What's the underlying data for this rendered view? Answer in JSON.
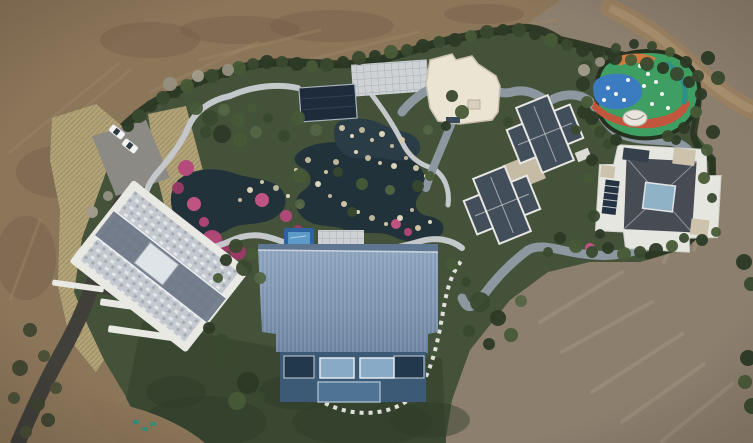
{
  "scene": {
    "description": "Aerial drone photograph of a landscaped private estate: a large blue-ribbed-roof barn house, a slate-roofed villa complex, a white flat-roof pavilion building, an ornamental garden with winding ponds, pink flower beds and stone paths, a colorful painted playground, a parking area with two white cars, curving roads, all surrounded by bare brown earth"
  },
  "palette": {
    "dirt_base": "#8c765a",
    "dirt_right": "#8d7f6e",
    "dirt_dark": "#76604a",
    "dirt_road": "#9a8162",
    "dirt_road_center": "#ab9270",
    "grass": "#44523a",
    "lawn": "#3a4832",
    "hedge": "#263220",
    "dry_grass": "#b2a378",
    "pond": "#22323b",
    "pond_light": "#2a3c46",
    "path_stone": "#c4c8cb",
    "road_loop": "#8d97a0",
    "asphalt": "#413f3a",
    "parking": "#8c8a85",
    "pavilion_roof": "#1d2b3b",
    "white_building": "#ece4d3",
    "white_building_edge": "#c9c0ae",
    "slate_roof": "#434e5b",
    "flat_white_roof": "#dcdcd6",
    "tan_courtyard": "#c6bca6",
    "right_house_white": "#e6e6e1",
    "right_house_dark": "#464b54",
    "skylight": "#8fb2c6",
    "slat_window": "#243241",
    "beige_patch": "#cdc2ab",
    "barn_roof_hi": "#8aa1bc",
    "barn_roof_lo": "#69809e",
    "facade": "#3c5a76",
    "window_glass": "#88aac6",
    "window_dark": "#22384c",
    "pool_border": "#2e63a2",
    "pool_inner": "#5c9bc8",
    "patio": "#ced2d5",
    "stepping_stone": "#e9e9e3",
    "playground_green": "#3f9e62",
    "playground_blue": "#3b7cc0",
    "playground_red": "#c2563c",
    "playground_orange": "#cf7a3e",
    "playground_teal": "#2e8f88",
    "dome_white": "#e8e6df",
    "car_white": "#f3f4f3",
    "car_glass": "#2f3a42",
    "terrace_white": "#e9e9e4",
    "flower_pink": "#b5477a"
  },
  "scatter": {
    "trees": {
      "colors": [
        "#2c3a26",
        "#39492e",
        "#475a36",
        "#536545"
      ],
      "items": [
        [
          128,
          126,
          6,
          0
        ],
        [
          139,
          116,
          7,
          1
        ],
        [
          151,
          106,
          6,
          0
        ],
        [
          163,
          98,
          7,
          1
        ],
        [
          175,
          92,
          6,
          0
        ],
        [
          187,
          86,
          7,
          2
        ],
        [
          199,
          80,
          6,
          0
        ],
        [
          212,
          76,
          7,
          1
        ],
        [
          225,
          72,
          6,
          0
        ],
        [
          239,
          68,
          7,
          2
        ],
        [
          253,
          64,
          6,
          1
        ],
        [
          267,
          62,
          7,
          0
        ],
        [
          282,
          62,
          6,
          1
        ],
        [
          297,
          64,
          7,
          0
        ],
        [
          312,
          66,
          6,
          2
        ],
        [
          327,
          65,
          7,
          1
        ],
        [
          343,
          62,
          6,
          0
        ],
        [
          359,
          58,
          7,
          1
        ],
        [
          375,
          56,
          6,
          0
        ],
        [
          391,
          52,
          7,
          2
        ],
        [
          407,
          50,
          6,
          1
        ],
        [
          423,
          46,
          7,
          0
        ],
        [
          439,
          42,
          6,
          1
        ],
        [
          455,
          40,
          7,
          0
        ],
        [
          471,
          36,
          6,
          2
        ],
        [
          487,
          32,
          7,
          1
        ],
        [
          503,
          30,
          6,
          0
        ],
        [
          519,
          30,
          7,
          1
        ],
        [
          535,
          34,
          6,
          0
        ],
        [
          551,
          40,
          7,
          2
        ],
        [
          567,
          45,
          6,
          1
        ],
        [
          583,
          50,
          7,
          0
        ],
        [
          599,
          54,
          6,
          1
        ],
        [
          615,
          58,
          7,
          0
        ],
        [
          631,
          60,
          6,
          2
        ],
        [
          647,
          64,
          7,
          1
        ],
        [
          663,
          68,
          6,
          0
        ],
        [
          677,
          74,
          7,
          1
        ],
        [
          689,
          82,
          6,
          0
        ],
        [
          196,
          108,
          7,
          2
        ],
        [
          210,
          118,
          8,
          1
        ],
        [
          224,
          110,
          6,
          3
        ],
        [
          238,
          120,
          7,
          2
        ],
        [
          206,
          132,
          6,
          1
        ],
        [
          222,
          134,
          9,
          0
        ],
        [
          240,
          140,
          7,
          2
        ],
        [
          256,
          132,
          6,
          3
        ],
        [
          268,
          118,
          5,
          1
        ],
        [
          252,
          108,
          5,
          2
        ],
        [
          298,
          118,
          7,
          2
        ],
        [
          284,
          136,
          6,
          1
        ],
        [
          316,
          130,
          6,
          3
        ],
        [
          300,
          176,
          7,
          2
        ],
        [
          338,
          172,
          5,
          1
        ],
        [
          362,
          184,
          6,
          2
        ],
        [
          390,
          190,
          5,
          3
        ],
        [
          418,
          186,
          6,
          1
        ],
        [
          430,
          176,
          5,
          2
        ],
        [
          352,
          212,
          5,
          1
        ],
        [
          300,
          204,
          5,
          3
        ],
        [
          452,
          96,
          6,
          1
        ],
        [
          462,
          112,
          7,
          2
        ],
        [
          446,
          126,
          5,
          0
        ],
        [
          428,
          130,
          5,
          3
        ],
        [
          508,
          122,
          5,
          1
        ],
        [
          584,
          112,
          7,
          0
        ],
        [
          596,
          126,
          6,
          2
        ],
        [
          576,
          130,
          5,
          1
        ],
        [
          236,
          246,
          7,
          1
        ],
        [
          252,
          254,
          6,
          2
        ],
        [
          226,
          260,
          6,
          0
        ],
        [
          244,
          268,
          8,
          1
        ],
        [
          260,
          278,
          6,
          3
        ],
        [
          218,
          278,
          5,
          2
        ],
        [
          230,
          360,
          12,
          1
        ],
        [
          248,
          383,
          11,
          0
        ],
        [
          237,
          401,
          9,
          2
        ],
        [
          222,
          342,
          8,
          1
        ],
        [
          209,
          328,
          6,
          0
        ],
        [
          258,
          398,
          7,
          1
        ],
        [
          480,
          302,
          10,
          1
        ],
        [
          498,
          318,
          8,
          0
        ],
        [
          511,
          335,
          7,
          2
        ],
        [
          469,
          331,
          6,
          1
        ],
        [
          521,
          301,
          6,
          3
        ],
        [
          452,
          264,
          6,
          2
        ],
        [
          466,
          282,
          5,
          1
        ],
        [
          489,
          344,
          6,
          0
        ],
        [
          548,
          252,
          5,
          1
        ],
        [
          560,
          238,
          6,
          0
        ],
        [
          576,
          246,
          7,
          2
        ],
        [
          592,
          252,
          6,
          1
        ],
        [
          608,
          248,
          6,
          0
        ],
        [
          624,
          254,
          7,
          2
        ],
        [
          640,
          252,
          6,
          1
        ],
        [
          656,
          250,
          7,
          0
        ],
        [
          672,
          246,
          6,
          2
        ],
        [
          684,
          238,
          5,
          1
        ],
        [
          592,
          160,
          6,
          0
        ],
        [
          588,
          178,
          5,
          2
        ],
        [
          594,
          216,
          6,
          1
        ],
        [
          600,
          234,
          5,
          0
        ],
        [
          704,
          178,
          6,
          2
        ],
        [
          712,
          198,
          5,
          1
        ],
        [
          702,
          240,
          6,
          0
        ],
        [
          716,
          232,
          5,
          2
        ],
        [
          608,
          144,
          5,
          1
        ],
        [
          676,
          140,
          5,
          0
        ],
        [
          598,
          52,
          6,
          0
        ],
        [
          586,
          66,
          6,
          1
        ],
        [
          583,
          84,
          7,
          0
        ],
        [
          587,
          102,
          6,
          2
        ],
        [
          592,
          118,
          7,
          0
        ],
        [
          600,
          132,
          6,
          1
        ],
        [
          616,
          140,
          6,
          0
        ],
        [
          668,
          136,
          6,
          1
        ],
        [
          684,
          128,
          6,
          0
        ],
        [
          696,
          112,
          6,
          2
        ],
        [
          701,
          94,
          6,
          0
        ],
        [
          698,
          76,
          6,
          1
        ],
        [
          686,
          62,
          6,
          0
        ],
        [
          670,
          52,
          5,
          2
        ],
        [
          652,
          46,
          5,
          1
        ],
        [
          634,
          44,
          5,
          0
        ],
        [
          616,
          48,
          5,
          1
        ],
        [
          708,
          58,
          7,
          0
        ],
        [
          718,
          78,
          7,
          1
        ],
        [
          713,
          132,
          7,
          0
        ],
        [
          707,
          150,
          6,
          2
        ],
        [
          744,
          262,
          8,
          0
        ],
        [
          751,
          284,
          7,
          1
        ],
        [
          748,
          358,
          8,
          0
        ],
        [
          745,
          382,
          7,
          2
        ],
        [
          752,
          406,
          8,
          1
        ]
      ]
    },
    "scrub": {
      "colors": [
        "#3f4430",
        "#4a4f36"
      ],
      "items": [
        [
          30,
          330,
          7
        ],
        [
          44,
          356,
          6
        ],
        [
          20,
          368,
          8
        ],
        [
          56,
          388,
          6
        ],
        [
          38,
          404,
          7
        ],
        [
          14,
          398,
          6
        ],
        [
          48,
          420,
          7
        ],
        [
          26,
          432,
          6
        ]
      ]
    },
    "bare": {
      "colors": [
        "#96907f",
        "#a39d8c"
      ],
      "items": [
        [
          170,
          84,
          7
        ],
        [
          198,
          76,
          6
        ],
        [
          228,
          70,
          6
        ],
        [
          584,
          70,
          6
        ],
        [
          600,
          62,
          5
        ],
        [
          92,
          212,
          6
        ],
        [
          108,
          196,
          5
        ]
      ]
    },
    "rocks": {
      "colors": [
        "#d8cbaa",
        "#e7ddc2",
        "#c7bda2"
      ],
      "items": [
        [
          342,
          128,
          3
        ],
        [
          352,
          136,
          2
        ],
        [
          362,
          130,
          3
        ],
        [
          372,
          140,
          2
        ],
        [
          382,
          134,
          3
        ],
        [
          392,
          146,
          2
        ],
        [
          402,
          140,
          3
        ],
        [
          356,
          152,
          2
        ],
        [
          368,
          158,
          3
        ],
        [
          380,
          163,
          2
        ],
        [
          394,
          166,
          3
        ],
        [
          406,
          158,
          2
        ],
        [
          416,
          168,
          3
        ],
        [
          426,
          176,
          2
        ],
        [
          336,
          162,
          3
        ],
        [
          326,
          172,
          2
        ],
        [
          318,
          184,
          3
        ],
        [
          330,
          196,
          2
        ],
        [
          344,
          204,
          3
        ],
        [
          358,
          212,
          2
        ],
        [
          372,
          218,
          3
        ],
        [
          386,
          224,
          2
        ],
        [
          400,
          218,
          3
        ],
        [
          412,
          210,
          2
        ],
        [
          300,
          206,
          3
        ],
        [
          288,
          196,
          2
        ],
        [
          276,
          188,
          3
        ],
        [
          262,
          182,
          2
        ],
        [
          250,
          190,
          3
        ],
        [
          240,
          200,
          2
        ],
        [
          418,
          228,
          3
        ],
        [
          430,
          222,
          2
        ],
        [
          308,
          160,
          3
        ],
        [
          296,
          170,
          2
        ]
      ]
    },
    "flowers": {
      "colors": [
        "#b5477a",
        "#9c3a66",
        "#c85585"
      ],
      "items": [
        [
          186,
          168,
          8
        ],
        [
          178,
          188,
          6
        ],
        [
          194,
          204,
          7
        ],
        [
          212,
          240,
          10
        ],
        [
          238,
          252,
          8
        ],
        [
          262,
          200,
          7
        ],
        [
          286,
          216,
          6
        ],
        [
          298,
          230,
          5
        ],
        [
          396,
          224,
          5
        ],
        [
          408,
          232,
          4
        ],
        [
          352,
          240,
          4
        ],
        [
          590,
          248,
          5
        ],
        [
          204,
          222,
          5
        ],
        [
          226,
          246,
          6
        ]
      ]
    }
  },
  "lines": {
    "dirt_streaks": {
      "stroke": "#9d8767",
      "w": 3,
      "op": 0.45,
      "items": [
        [
          10,
          152,
          118,
          64
        ],
        [
          150,
          92,
          258,
          42
        ],
        [
          300,
          62,
          418,
          32
        ],
        [
          430,
          42,
          556,
          20
        ],
        [
          40,
          220,
          10,
          300
        ],
        [
          70,
          120,
          130,
          70
        ],
        [
          200,
          60,
          320,
          30
        ]
      ]
    },
    "tracks": {
      "stroke": "#a29580",
      "w": 4,
      "op": 0.5,
      "items": [
        [
          540,
          322,
          622,
          272
        ],
        [
          562,
          352,
          652,
          302
        ],
        [
          592,
          392,
          682,
          334
        ],
        [
          622,
          422,
          704,
          364
        ],
        [
          662,
          441,
          732,
          384
        ],
        [
          700,
          182,
          664,
          262
        ],
        [
          716,
          170,
          694,
          250
        ]
      ]
    }
  },
  "patches": {
    "dirt": {
      "fill": "#76604a",
      "op": 0.5,
      "items": [
        [
          58,
          172,
          42,
          26
        ],
        [
          26,
          258,
          30,
          42
        ],
        [
          332,
          26,
          62,
          16
        ],
        [
          484,
          14,
          40,
          10
        ],
        [
          150,
          40,
          50,
          18
        ],
        [
          240,
          30,
          60,
          14
        ]
      ]
    },
    "grass": {
      "fill": "#2e3b29",
      "op": 0.45,
      "items": [
        [
          205,
          422,
          62,
          26
        ],
        [
          362,
          422,
          70,
          24
        ],
        [
          300,
          392,
          42,
          18
        ],
        [
          176,
          392,
          30,
          16
        ],
        [
          430,
          420,
          40,
          18
        ]
      ]
    }
  },
  "playground": {
    "dots": [
      [
        608,
        88
      ],
      [
        616,
        94
      ],
      [
        604,
        100
      ],
      [
        648,
        74
      ],
      [
        656,
        82
      ],
      [
        644,
        86
      ],
      [
        662,
        94
      ],
      [
        640,
        66
      ],
      [
        628,
        80
      ],
      [
        652,
        104
      ],
      [
        668,
        108
      ],
      [
        624,
        100
      ]
    ]
  },
  "cars": {
    "items": [
      [
        117,
        132,
        38
      ],
      [
        130,
        146,
        38
      ]
    ]
  },
  "paint_marks": {
    "color": "#2e8f7a",
    "items": [
      [
        133,
        420
      ],
      [
        142,
        427
      ],
      [
        150,
        422
      ]
    ]
  }
}
